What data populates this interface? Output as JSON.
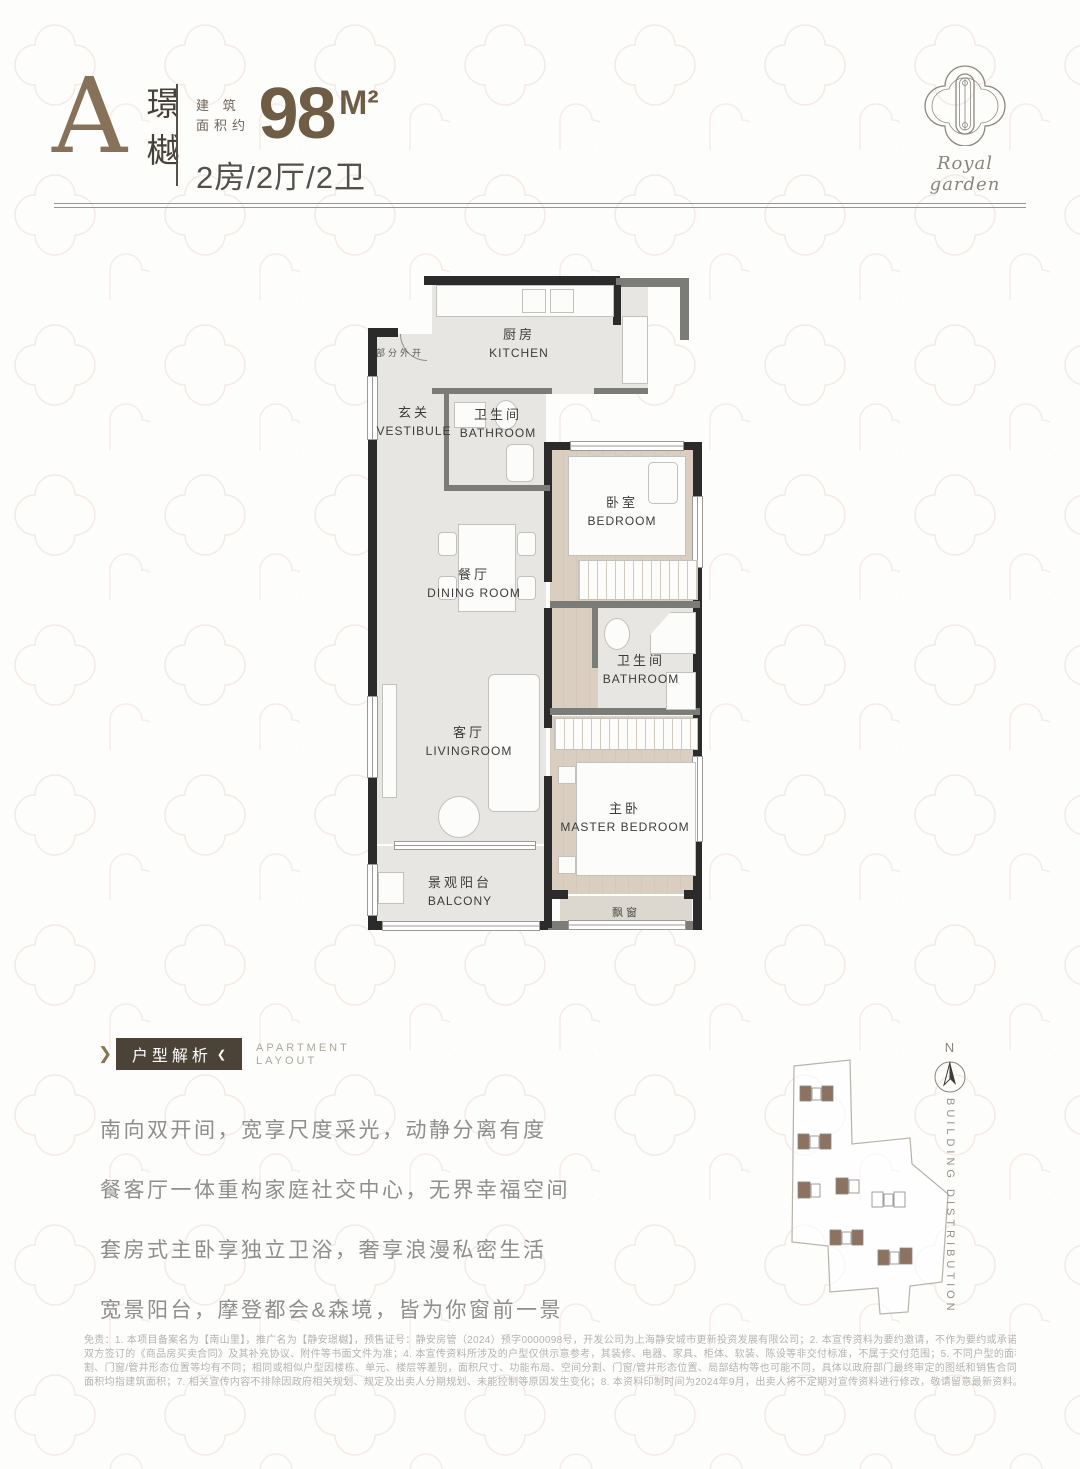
{
  "header": {
    "plan_letter": "A",
    "plan_name": "璟樾",
    "area_label_line1": "建 筑",
    "area_label_line2": "面积约",
    "area_value": "98",
    "area_unit": "M²",
    "layout_spec": "2房/2厅/2卫"
  },
  "logo": {
    "brand_script": "Royal garden"
  },
  "floorplan": {
    "rooms": [
      {
        "cn": "厨房",
        "en": "KITCHEN"
      },
      {
        "cn": "玄关",
        "en": "VESTIBULE"
      },
      {
        "cn": "卫生间",
        "en": "BATHROOM"
      },
      {
        "cn": "餐厅",
        "en": "DINING ROOM"
      },
      {
        "cn": "卧室",
        "en": "BEDROOM"
      },
      {
        "cn": "卫生间",
        "en": "BATHROOM"
      },
      {
        "cn": "客厅",
        "en": "LIVINGROOM"
      },
      {
        "cn": "主卧",
        "en": "MASTER BEDROOM"
      },
      {
        "cn": "景观阳台",
        "en": "BALCONY"
      }
    ],
    "notes": {
      "door_note": "部分外开",
      "bay_window": "飘窗"
    }
  },
  "analysis": {
    "badge": "户型解析",
    "subtitle_line1": "APARTMENT",
    "subtitle_line2": "LAYOUT",
    "body_lines": [
      "南向双开间，宽享尺度采光，动静分离有度",
      "餐客厅一体重构家庭社交中心，无界幸福空间",
      "套房式主卧享独立卫浴，奢享浪漫私密生活",
      "宽景阳台，摩登都会&森境，皆为你窗前一景"
    ]
  },
  "siteplan": {
    "compass": "N",
    "label": "BUILDING DISTRIBUTION"
  },
  "footer": {
    "lines": [
      "免责：1. 本项目备案名为【南山里】，推广名为【静安璟樾】，预售证号：静安房管（2024）预字0000098号，开发公司为上海静安城市更新投资发展有限公司；2. 本宣传资料为要约邀请，不作为要约或承诺；3. 买卖双方的权利义务以",
      "双方签订的《商品房买卖合同》及其补充协议、附件等书面文件为准；4. 本宣传资料所涉及的户型仅供示意参考，其装修、电器、家具、柜体、软装、陈设等非交付标准，不属于交付范围；5. 不同户型的面积尺寸、功能布局、空间分",
      "割、门窗/管井形态位置等均有不同；相同或相似户型因楼栋、单元、楼层等差别，面积尺寸、功能布局、空间分割、门窗/管井形态位置、局部结构等也可能不同，具体以政府部门最终审定的图纸和销售合同为准；6. 本资料中所述",
      "面积均指建筑面积；7. 相关宣传内容不排除因政府相关规划、规定及出卖人分期规划、未能控制等原因发生变化；8. 本资料印制时间为2024年9月，出卖人将不定期对宣传资料进行修改，敬请留意最新资料。"
    ]
  },
  "colors": {
    "accent_brown": "#877259",
    "number_brown": "#6e5c44",
    "badge_bg": "#4b4238",
    "wall_dark": "#2b2b2b",
    "wall_gray": "#7b7b78",
    "floor_light": "#e7e6e3",
    "floor_beige": "#d9cec0",
    "building_fill": "#8d7260",
    "body_text": "#8e8e8e"
  }
}
